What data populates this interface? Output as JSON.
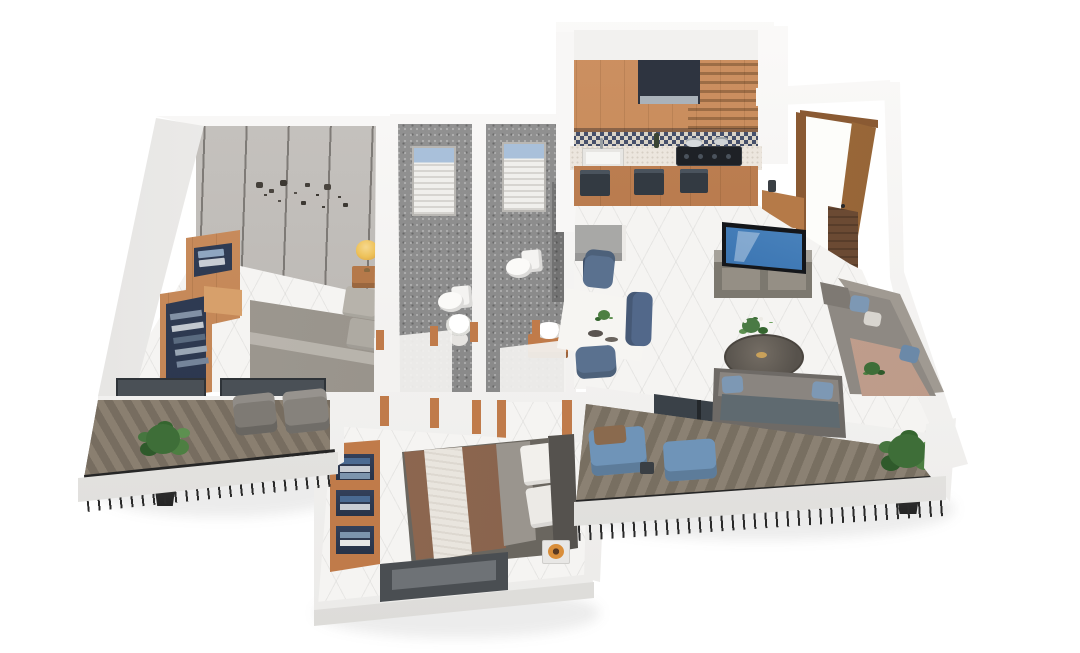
{
  "scene": {
    "title": "2 BHK apartment — 3D isometric floor plan render",
    "view": "isometric dollhouse, viewed from the front",
    "background": "#ffffff",
    "visible_text": "none"
  },
  "palette": {
    "wall_white": "#f6f5f3",
    "floor_tile": "#f5f4f2",
    "bathroom_tile_gray": "#8d8d8d",
    "wood_cabinet": "#c5885a",
    "wood_frame_orange": "#c07b4a",
    "door_wood": "#a9743f",
    "backsplash_navy": "#46506b",
    "backsplash_cream": "#d9d3c7",
    "appliance_dark": "#2e3440",
    "sofa_gray": "#8e8983",
    "pillow_blue": "#7d98b4",
    "chaise_tan": "#c2a193",
    "dining_chair_blue": "#5a718f",
    "lounger_blue": "#6f94b8",
    "master_bed_gray": "#9b968e",
    "bed2_duvet_brown": "#8d6850",
    "bed2_throw_white": "#e9e5de",
    "headboard_dark": "#55524e",
    "wardrobe_interior_navy": "#2e3a4e",
    "deck_wood": "#82786a",
    "railing_black": "#262626",
    "plant_green": "#3e6e38",
    "lamp_yellow": "#eec25a",
    "tv_screen_blue": "#2b66a8",
    "glass_dark": "#3f464c",
    "marble_white": "#f4f3f0",
    "accent_bowl_orange": "#d98e3a"
  },
  "rooms": {
    "master_bedroom": {
      "title": "Master bedroom",
      "items": [
        "double bed with gray bedding",
        "panelled feature wall with metal wall art",
        "wardrobe unit with hanging clothes",
        "nightstand",
        "yellow table lamp",
        "two windows to balcony"
      ]
    },
    "bathroom_1": {
      "title": "Bathroom 1",
      "items": [
        "gray mosaic tiling",
        "window with blinds",
        "toilet",
        "round washbasin",
        "shower screens with wood posts"
      ]
    },
    "bathroom_2": {
      "title": "Bathroom 2",
      "items": [
        "gray mosaic tiling",
        "window with blinds",
        "toilet",
        "washbasin on wooden vanity"
      ]
    },
    "kitchen": {
      "title": "Kitchen",
      "items": [
        "upper wooden cabinets",
        "dark range hood",
        "mosaic backsplash",
        "speckled countertop",
        "sink",
        "gas hob with pots",
        "base cabinets with built-in appliances",
        "refrigerator / counter unit"
      ]
    },
    "entry": {
      "title": "Entry foyer",
      "items": [
        "open wooden entry door",
        "shoe bench",
        "dark wood wall panel"
      ]
    },
    "living_dining": {
      "title": "Living / dining room",
      "items": [
        "marble dining table",
        "blue dining chairs",
        "TV on media unit",
        "round coffee table with plant",
        "gray corner sectional sofa with blue pillows",
        "tan chaise",
        "two-seat sofa facing coffee table",
        "glass door to balcony"
      ]
    },
    "bedroom_2": {
      "title": "Bedroom 2",
      "items": [
        "double bed with brown duvet and white throw",
        "dark headboard",
        "open shelf unit with blue towels",
        "side table with orange bowl",
        "low window"
      ]
    },
    "balcony_left": {
      "title": "Left balcony",
      "items": [
        "chevron wood deck",
        "black metal railing",
        "potted plant",
        "two gray armchairs"
      ]
    },
    "balcony_main": {
      "title": "Main balcony",
      "items": [
        "herringbone wood deck",
        "black metal railing",
        "two blue loungers",
        "small side table",
        "potted plant"
      ]
    }
  },
  "counts": {
    "bedrooms": 2,
    "bathrooms": 2,
    "balconies": 2,
    "dining_chairs": 3,
    "potted_plants": 4,
    "sofas": 2,
    "toilets": 2,
    "washbasins": 2
  }
}
